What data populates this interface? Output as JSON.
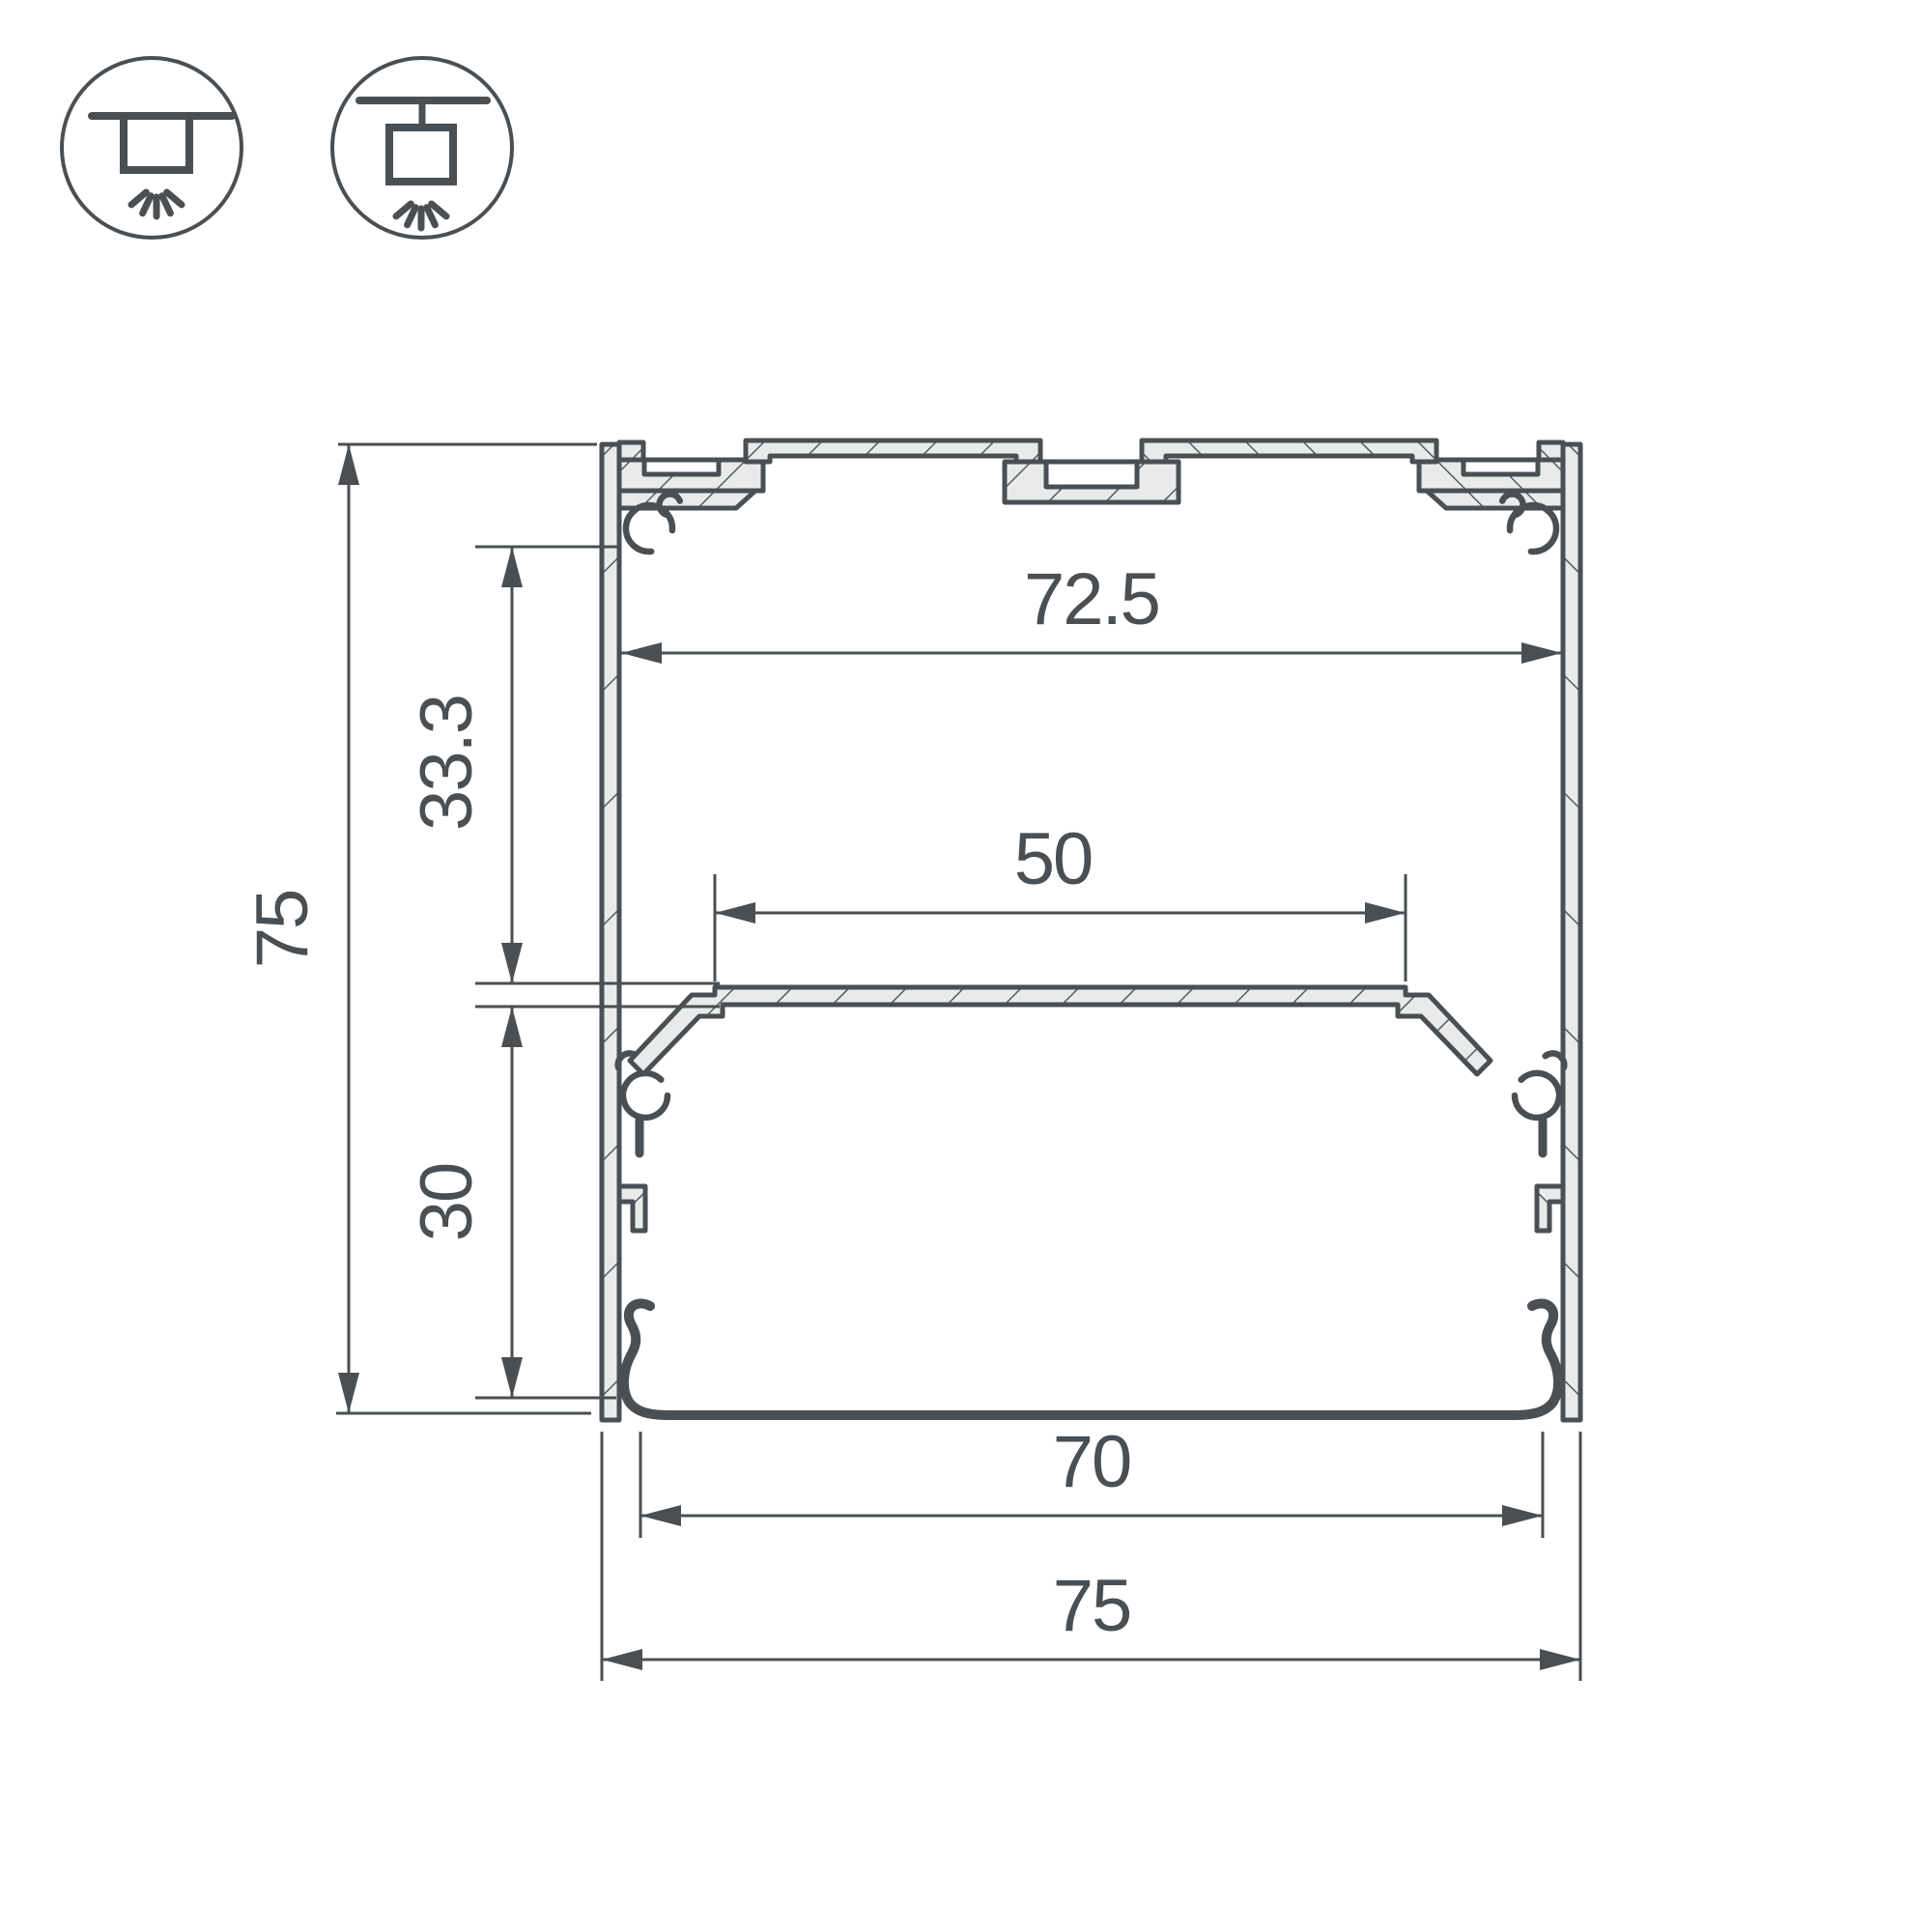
{
  "drawing": {
    "type": "aluminum-led-profile-cross-section",
    "units": "mm"
  },
  "icons": {
    "surface_mount": "surface-mount-light-icon",
    "pendant_mount": "pendant-mount-light-icon"
  },
  "dimensions": {
    "overall_height": "75",
    "top_inner_width": "72.5",
    "upper_cavity_depth": "33.3",
    "led_shelf_width": "50",
    "lower_cavity_depth": "30",
    "diffuser_width": "70",
    "overall_width": "75"
  },
  "colors": {
    "line": "#4a4f53",
    "metal_fill": "#e9ebea",
    "hatch": "#565b5f",
    "background": "#ffffff"
  }
}
